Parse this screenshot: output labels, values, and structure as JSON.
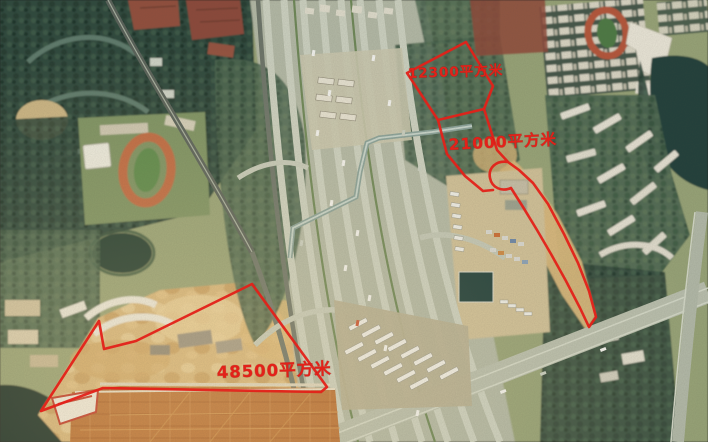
{
  "scene": {
    "kind": "aerial satellite photo with land-plot annotations",
    "visible_features": [
      "freeway checkpoint interchange running through center",
      "toll / checkpoint lanes at top center",
      "zig-zag pedestrian footbridge over the roadway",
      "school running track on west side",
      "small running track in northeast block",
      "dense urban-village grid at top right",
      "lake at upper right",
      "bus depot with rows of parked buses at bottom center",
      "truck and container parking east of the freeway",
      "construction dirt site in the southwest",
      "large orange factory roof at the bottom",
      "residential building rows at top left and right"
    ]
  },
  "annotations": {
    "color": "#e32119",
    "unit": "平方米",
    "plots": [
      {
        "id": "north-plot",
        "area_sqm": 12300,
        "area_label": "12300平方米"
      },
      {
        "id": "middle-plot",
        "area_sqm": 21000,
        "area_label": "21000平方米"
      },
      {
        "id": "south-plot",
        "area_sqm": 48500,
        "area_label": "48500平方米"
      }
    ]
  }
}
